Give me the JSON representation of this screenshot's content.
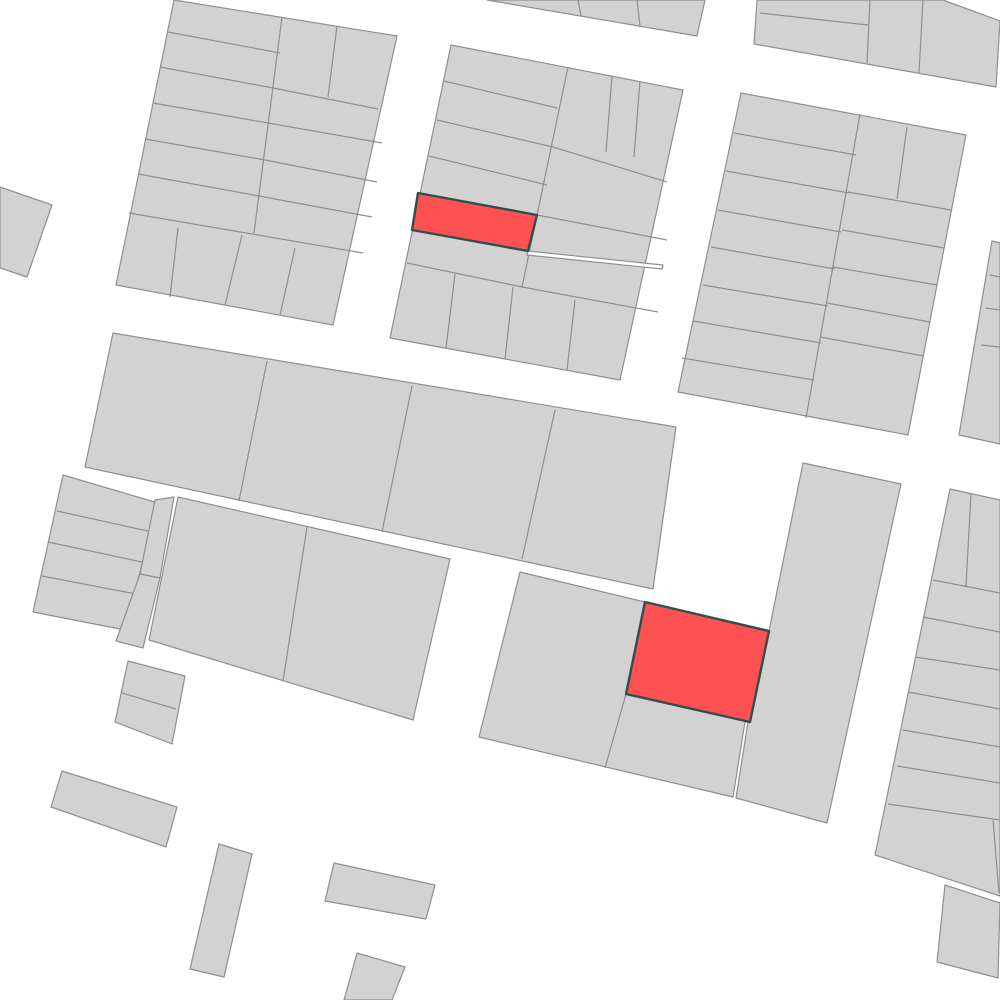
{
  "map": {
    "canvas": {
      "width": 1000,
      "height": 1000,
      "background": "#ffffff"
    },
    "colors": {
      "parcel_fill": "#d2d2d2",
      "parcel_stroke": "#8f8f8f",
      "highlight_fill": "#fd5152",
      "highlight_stroke": "#2f4f4f",
      "gap_fill": "#ffffff"
    },
    "stroke_widths": {
      "parcel": 1.2,
      "highlight": 2.4
    },
    "blocks": [
      {
        "name": "block-top-left",
        "outline": [
          [
            174,
            0
          ],
          [
            397,
            36
          ],
          [
            333,
            325
          ],
          [
            116,
            285
          ]
        ],
        "lines": [
          [
            [
              282,
              17
            ],
            [
              254,
              233
            ]
          ],
          [
            [
              168,
              32
            ],
            [
              280,
              53
            ]
          ],
          [
            [
              160,
              67
            ],
            [
              273,
              88
            ]
          ],
          [
            [
              153,
              103
            ],
            [
              268,
              123
            ]
          ],
          [
            [
              145,
              139
            ],
            [
              265,
              160
            ]
          ],
          [
            [
              138,
              174
            ],
            [
              259,
              196
            ]
          ],
          [
            [
              129,
              213
            ],
            [
              363,
              253
            ]
          ],
          [
            [
              337,
              26
            ],
            [
              328,
              97
            ]
          ],
          [
            [
              273,
              88
            ],
            [
              378,
              109
            ]
          ],
          [
            [
              268,
              123
            ],
            [
              382,
              143
            ]
          ],
          [
            [
              265,
              160
            ],
            [
              377,
              182
            ]
          ],
          [
            [
              259,
              196
            ],
            [
              372,
              217
            ]
          ],
          [
            [
              178,
              228
            ],
            [
              170,
              297
            ]
          ],
          [
            [
              242,
              235
            ],
            [
              225,
              305
            ]
          ],
          [
            [
              295,
              248
            ],
            [
              280,
              315
            ]
          ]
        ]
      },
      {
        "name": "block-top-strip",
        "outline": [
          [
            487,
            0
          ],
          [
            705,
            0
          ],
          [
            697,
            36
          ]
        ],
        "lines": [
          [
            [
              578,
              0
            ],
            [
              581,
              16
            ]
          ],
          [
            [
              637,
              0
            ],
            [
              640,
              26
            ]
          ]
        ]
      },
      {
        "name": "block-top-right-mini",
        "outline": [
          [
            757,
            0
          ],
          [
            943,
            0
          ],
          [
            1000,
            21
          ],
          [
            996,
            87
          ],
          [
            754,
            44
          ]
        ],
        "lines": [
          [
            [
              760,
              13
            ],
            [
              868,
              25
            ]
          ],
          [
            [
              870,
              0
            ],
            [
              867,
              63
            ]
          ],
          [
            [
              923,
              0
            ],
            [
              919,
              73
            ]
          ]
        ]
      },
      {
        "name": "block-top-middle",
        "outline": [
          [
            451,
            45
          ],
          [
            683,
            90
          ],
          [
            620,
            380
          ],
          [
            390,
            338
          ]
        ],
        "lines": [
          [
            [
              568,
              67
            ],
            [
              522,
              287
            ]
          ],
          [
            [
              444,
              81
            ],
            [
              557,
              108
            ]
          ],
          [
            [
              437,
              120
            ],
            [
              553,
              147
            ]
          ],
          [
            [
              429,
              156
            ],
            [
              547,
              185
            ]
          ],
          [
            [
              553,
              147
            ],
            [
              667,
              182
            ]
          ],
          [
            [
              537,
              215
            ],
            [
              667,
              240
            ]
          ],
          [
            [
              612,
              76
            ],
            [
              606,
              152
            ]
          ],
          [
            [
              640,
              81
            ],
            [
              634,
              157
            ]
          ],
          [
            [
              407,
              263
            ],
            [
              522,
              287
            ]
          ],
          [
            [
              522,
              287
            ],
            [
              658,
              312
            ]
          ],
          [
            [
              455,
              274
            ],
            [
              446,
              348
            ]
          ],
          [
            [
              513,
              287
            ],
            [
              505,
              359
            ]
          ],
          [
            [
              575,
              300
            ],
            [
              567,
              370
            ]
          ]
        ]
      },
      {
        "name": "block-top-right",
        "outline": [
          [
            741,
            93
          ],
          [
            966,
            135
          ],
          [
            908,
            435
          ],
          [
            678,
            392
          ]
        ],
        "lines": [
          [
            [
              860,
              114
            ],
            [
              806,
              418
            ]
          ],
          [
            [
              734,
              133
            ],
            [
              856,
              155
            ]
          ],
          [
            [
              726,
              171
            ],
            [
              849,
              193
            ]
          ],
          [
            [
              718,
              210
            ],
            [
              841,
              232
            ]
          ],
          [
            [
              711,
              247
            ],
            [
              835,
              269
            ]
          ],
          [
            [
              703,
              285
            ],
            [
              828,
              306
            ]
          ],
          [
            [
              693,
              321
            ],
            [
              821,
              343
            ]
          ],
          [
            [
              682,
              358
            ],
            [
              814,
              380
            ]
          ],
          [
            [
              907,
              127
            ],
            [
              897,
              199
            ]
          ],
          [
            [
              848,
              192
            ],
            [
              951,
              210
            ]
          ],
          [
            [
              842,
              230
            ],
            [
              944,
              248
            ]
          ],
          [
            [
              833,
              267
            ],
            [
              937,
              285
            ]
          ],
          [
            [
              827,
              303
            ],
            [
              930,
              322
            ]
          ],
          [
            [
              820,
              337
            ],
            [
              924,
              356
            ]
          ]
        ]
      },
      {
        "name": "sliver-right-top",
        "outline": [
          [
            992,
            241
          ],
          [
            1000,
            243
          ],
          [
            1000,
            444
          ],
          [
            959,
            435
          ]
        ],
        "lines": [
          [
            [
              990,
              275
            ],
            [
              1000,
              277
            ]
          ],
          [
            [
              985,
              308
            ],
            [
              1000,
              310
            ]
          ],
          [
            [
              981,
              345
            ],
            [
              1000,
              347
            ]
          ]
        ]
      },
      {
        "name": "wedge-far-left",
        "outline": [
          [
            0,
            187
          ],
          [
            52,
            205
          ],
          [
            27,
            277
          ],
          [
            0,
            268
          ]
        ],
        "lines": []
      },
      {
        "name": "block-middle-band",
        "outline": [
          [
            113,
            333
          ],
          [
            676,
            427
          ],
          [
            653,
            589
          ],
          [
            85,
            467
          ]
        ],
        "lines": [
          [
            [
              267,
              361
            ],
            [
              239,
              501
            ]
          ],
          [
            [
              412,
              386
            ],
            [
              382,
              532
            ]
          ],
          [
            [
              555,
              410
            ],
            [
              522,
              559
            ]
          ]
        ]
      },
      {
        "name": "block-left-rows",
        "outline": [
          [
            63,
            475
          ],
          [
            158,
            503
          ],
          [
            125,
            630
          ],
          [
            33,
            612
          ]
        ],
        "lines": [
          [
            [
              57,
              511
            ],
            [
              152,
              532
            ]
          ],
          [
            [
              48,
              542
            ],
            [
              142,
              562
            ]
          ],
          [
            [
              42,
              576
            ],
            [
              136,
              594
            ]
          ]
        ]
      },
      {
        "name": "strip-parcel-upper",
        "outline": [
          [
            155,
            500
          ],
          [
            174,
            497
          ],
          [
            160,
            578
          ],
          [
            140,
            574
          ]
        ],
        "lines": []
      },
      {
        "name": "strip-parcel-lower",
        "outline": [
          [
            140,
            574
          ],
          [
            160,
            578
          ],
          [
            143,
            648
          ],
          [
            116,
            641
          ]
        ],
        "lines": []
      },
      {
        "name": "block-second-row",
        "outline": [
          [
            178,
            497
          ],
          [
            450,
            559
          ],
          [
            413,
            720
          ],
          [
            149,
            640
          ]
        ],
        "lines": [
          [
            [
              307,
              527
            ],
            [
              283,
              681
            ]
          ]
        ]
      },
      {
        "name": "block-small-pair",
        "outline": [
          [
            128,
            661
          ],
          [
            185,
            676
          ],
          [
            172,
            744
          ],
          [
            115,
            722
          ]
        ],
        "lines": [
          [
            [
              122,
              693
            ],
            [
              176,
              709
            ]
          ]
        ]
      },
      {
        "name": "block-bottom-middle",
        "outline": [
          [
            520,
            572
          ],
          [
            645,
            602
          ],
          [
            769,
            631
          ],
          [
            750,
            722
          ],
          [
            745,
            722
          ],
          [
            733,
            797
          ],
          [
            479,
            737
          ]
        ],
        "lines": [
          [
            [
              626,
              694
            ],
            [
              605,
              768
            ]
          ]
        ]
      },
      {
        "name": "block-tall-right",
        "outline": [
          [
            803,
            463
          ],
          [
            901,
            484
          ],
          [
            827,
            823
          ],
          [
            736,
            798
          ],
          [
            748,
            722
          ],
          [
            769,
            631
          ]
        ],
        "lines": []
      },
      {
        "name": "block-right-column",
        "outline": [
          [
            950,
            489
          ],
          [
            1000,
            500
          ],
          [
            1000,
            896
          ],
          [
            875,
            855
          ]
        ],
        "lines": [
          [
            [
              933,
              580
            ],
            [
              1000,
              593
            ]
          ],
          [
            [
              923,
              617
            ],
            [
              1000,
              632
            ]
          ],
          [
            [
              915,
              657
            ],
            [
              1000,
              670
            ]
          ],
          [
            [
              908,
              692
            ],
            [
              1000,
              709
            ]
          ],
          [
            [
              903,
              730
            ],
            [
              1000,
              747
            ]
          ],
          [
            [
              897,
              766
            ],
            [
              1000,
              783
            ]
          ],
          [
            [
              888,
              804
            ],
            [
              1000,
              820
            ]
          ],
          [
            [
              971,
              493
            ],
            [
              966,
              586
            ]
          ],
          [
            [
              993,
              820
            ],
            [
              999,
              893
            ]
          ]
        ]
      },
      {
        "name": "parcel-bottom-right",
        "outline": [
          [
            945,
            885
          ],
          [
            1000,
            903
          ],
          [
            998,
            978
          ],
          [
            937,
            962
          ]
        ],
        "lines": []
      },
      {
        "name": "rect-left-low",
        "outline": [
          [
            62,
            771
          ],
          [
            177,
            807
          ],
          [
            166,
            847
          ],
          [
            51,
            807
          ]
        ],
        "lines": []
      },
      {
        "name": "rect-tall-narrow",
        "outline": [
          [
            219,
            844
          ],
          [
            252,
            854
          ],
          [
            224,
            977
          ],
          [
            190,
            969
          ]
        ],
        "lines": []
      },
      {
        "name": "rect-center-low",
        "outline": [
          [
            334,
            863
          ],
          [
            435,
            885
          ],
          [
            426,
            919
          ],
          [
            325,
            901
          ]
        ],
        "lines": []
      },
      {
        "name": "rect-bottom-edge",
        "outline": [
          [
            357,
            953
          ],
          [
            405,
            967
          ],
          [
            392,
            1000
          ],
          [
            344,
            1000
          ]
        ],
        "lines": []
      }
    ],
    "gaps": [
      {
        "name": "sliver-gap-top-middle",
        "outline": [
          [
            528,
            251
          ],
          [
            663,
            265
          ],
          [
            662,
            269
          ],
          [
            527,
            255
          ]
        ]
      }
    ],
    "highlights": [
      {
        "name": "highlighted-parcel-1",
        "outline": [
          [
            418,
            193
          ],
          [
            537,
            215
          ],
          [
            528,
            251
          ],
          [
            412,
            230
          ]
        ]
      },
      {
        "name": "highlighted-parcel-2",
        "outline": [
          [
            645,
            602
          ],
          [
            769,
            631
          ],
          [
            750,
            722
          ],
          [
            626,
            694
          ]
        ]
      }
    ]
  }
}
